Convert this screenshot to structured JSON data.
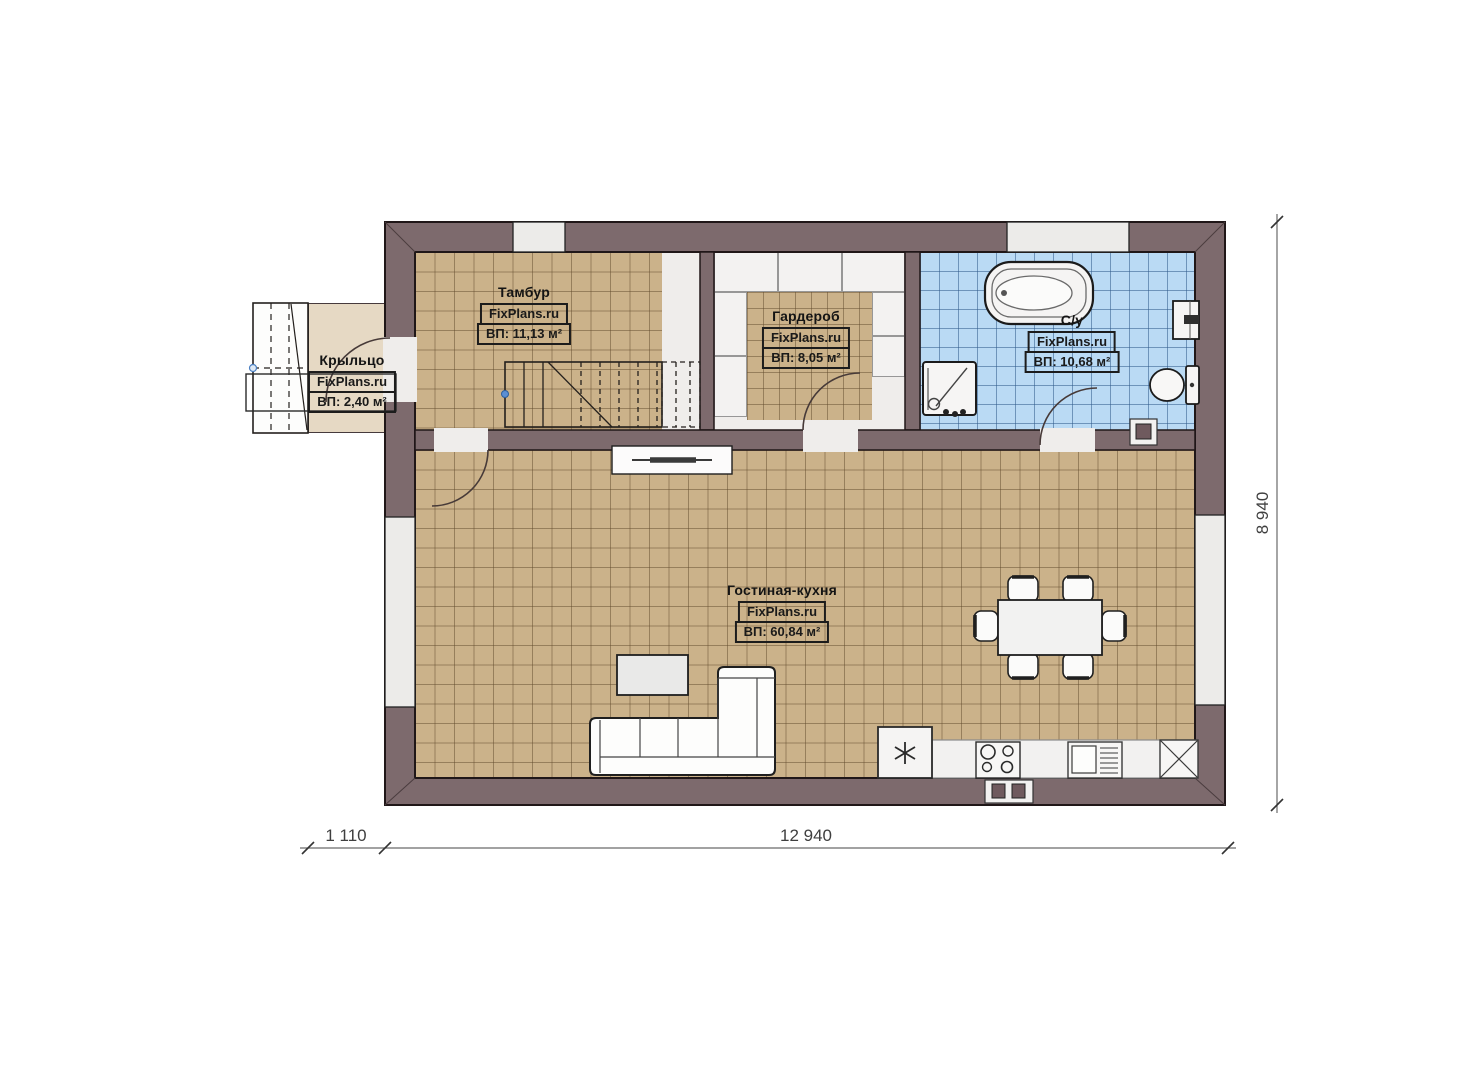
{
  "rooms": [
    {
      "name": "Тамбур",
      "watermark": "FixPlans.ru",
      "area": "ВП: 11,13 м²"
    },
    {
      "name": "Гардероб",
      "watermark": "FixPlans.ru",
      "area": "ВП: 8,05 м²"
    },
    {
      "name": "С/у",
      "watermark": "FixPlans.ru",
      "area": "ВП: 10,68 м²"
    },
    {
      "name": "Крыльцо",
      "watermark": "FixPlans.ru",
      "area": "ВП: 2,40 м²"
    },
    {
      "name": "Гостиная-кухня",
      "watermark": "FixPlans.ru",
      "area": "ВП: 60,84 м²"
    }
  ],
  "dimensions": {
    "porch_width": "1 110",
    "house_width": "12 940",
    "house_height": "8 940"
  },
  "colors": {
    "wall": "#7d6a6d",
    "floor_tile_tan": "#cbb28a",
    "floor_tile_blue": "#badaf4",
    "porch_floor": "#e6d9c4",
    "floor_white": "#efedeb",
    "stair_pivot_dot": "#5b8fd4"
  }
}
